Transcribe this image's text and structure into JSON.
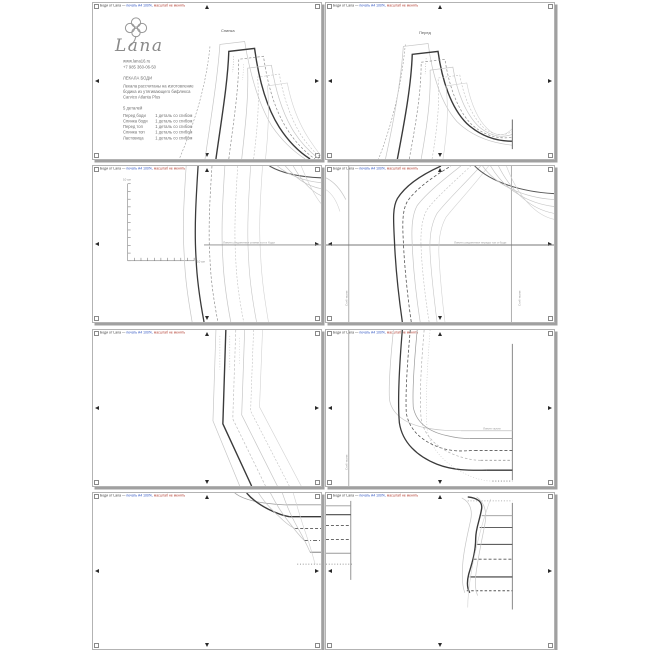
{
  "document": {
    "kind": "sewing-pattern-print-sheet",
    "pages_count": 8,
    "brand": "Lana"
  },
  "page_header": {
    "segments": [
      {
        "t": "Боди от Lana —",
        "c": "#3a3a3a"
      },
      {
        "t": " печать А4 100%,",
        "c": "#2b51c0"
      },
      {
        "t": " масштаб не менять",
        "c": "#b23b2e"
      }
    ]
  },
  "logo_block": {
    "brand": "Lana",
    "website": "www.lana16.ru",
    "phone": "+7 985 360-06-50",
    "title": "ЛЕКАЛА БОДИ",
    "description_lines": [
      "Лекала рассчитаны на изготовление",
      "бодика из утягивающего бифлекса",
      "Carvico Atlanta Plus"
    ],
    "parts_count_label": "5 деталей",
    "parts": [
      {
        "name": "Перед боди",
        "qty": "1 деталь со сгибом"
      },
      {
        "name": "Спинка боди",
        "qty": "1 деталь со сгибом"
      },
      {
        "name": "Перед топ",
        "qty": "1 деталь со сгибом"
      },
      {
        "name": "Спинка топ",
        "qty": "1 деталь со сгибом"
      },
      {
        "name": "Ластовица",
        "qty": "1 деталь со сгибом"
      }
    ]
  },
  "colors": {
    "bold_line": "#3a3a3a",
    "dark_line": "#555555",
    "mid_line": "#9a9a9a",
    "light_line": "#c6c6c6",
    "page_shadow": "#a0a0a0",
    "page_border": "#b3b3b3"
  },
  "pages": [
    {
      "strokes": [
        {
          "d": "M118,44 C114,84 103,120 87,158",
          "c": "#9a9a9a",
          "w": 0.6,
          "da": "2 1.6"
        },
        {
          "d": "M113,158 C120,110 126,72 128,42 L153,39 C158,70 166,100 180,124 C190,139 202,150 214,158",
          "c": "#c6c6c6",
          "w": 0.7
        },
        {
          "d": "M124,158 C130,115 136,80 137,49 L163,46 C167,76 174,104 188,126 C197,140 208,151 219,158",
          "c": "#3a3a3a",
          "w": 1.4
        },
        {
          "d": "M137,158 C142,118 147,88 147,57 L172,54 C176,82 183,108 196,128 C204,141 214,151 224,158",
          "c": "#8f8f8f",
          "w": 0.7,
          "da": "2.5 1.8"
        },
        {
          "d": "M150,158 C154,122 157,95 156,66 L180,63 C184,88 191,112 203,131 C210,142 219,151 228,158",
          "c": "#c6c6c6",
          "w": 0.7
        },
        {
          "d": "M162,158 C166,126 168,100 166,75 L188,72 C192,95 199,116 210,134 C216,143 224,152 230,157",
          "c": "#c0c0c0",
          "w": 0.6,
          "da": "2 1.6"
        },
        {
          "d": "M174,158 C177,130 178,106 176,84 L196,81 C200,102 207,121 218,138 C222,144 227,151 230,155",
          "c": "#d2d2d2",
          "w": 0.6
        },
        {
          "d": "M142,54 L141,70",
          "c": "#9a9a9a",
          "w": 0.5,
          "da": "1 1.6"
        },
        {
          "d": "M152,62 L151,78",
          "c": "#b8b8b8",
          "w": 0.5,
          "da": "1 1.6"
        }
      ],
      "labels": [
        {
          "t": "Спинка",
          "x": 128,
          "y": 26,
          "s": 4,
          "c": "#555555",
          "n": "piece-label-spinka"
        }
      ]
    },
    {
      "strokes": [
        {
          "d": "M80,42 C76,84 67,122 53,158",
          "c": "#9a9a9a",
          "w": 0.6,
          "da": "2 1.6"
        },
        {
          "d": "M60,158 C70,112 76,74 78,44 L103,41 C107,72 116,102 132,120 C148,136 168,142 188,144",
          "c": "#c6c6c6",
          "w": 0.7
        },
        {
          "d": "M72,158 C80,116 86,82 87,52 L113,49 C117,78 126,106 142,122 C156,135 172,140 188,140",
          "c": "#3a3a3a",
          "w": 1.4
        },
        {
          "d": "M84,158 C91,120 96,90 96,60 L120,57 C124,84 133,110 148,124 C161,135 175,138 188,136",
          "c": "#8f8f8f",
          "w": 0.7,
          "da": "2.5 1.8"
        },
        {
          "d": "M96,158 C102,124 106,96 105,68 L128,65 C132,90 141,113 155,126 C166,135 178,137 188,133",
          "c": "#c6c6c6",
          "w": 0.7
        },
        {
          "d": "M107,158 C112,128 115,102 113,76 L135,73 C139,96 148,117 161,128 C170,134 180,135 188,130",
          "c": "#c0c0c0",
          "w": 0.6,
          "da": "2 1.6"
        },
        {
          "d": "M118,158 C122,132 124,108 121,84 L142,81 C146,102 154,121 166,130 C173,135 181,135 188,127",
          "c": "#d2d2d2",
          "w": 0.6
        },
        {
          "d": "M188,118 L188,148",
          "c": "#777777",
          "w": 1.1
        },
        {
          "d": "M101,56 L100,72",
          "c": "#9a9a9a",
          "w": 0.5,
          "da": "1 1.6"
        }
      ],
      "labels": [
        {
          "t": "Перед",
          "x": 93,
          "y": 28,
          "s": 4,
          "c": "#555555",
          "n": "piece-label-pered"
        }
      ]
    },
    {
      "strokes": [
        {
          "d": "M35,18 L35,96 M35,18 L38,18 M35,25.8 L38,25.8 M35,33.6 L38,33.6 M35,41.4 L38,41.4 M35,49.2 L38,49.2 M35,57 L38,57 M35,64.8 L38,64.8 M35,72.6 L38,72.6 M35,80.4 L38,80.4 M35,88.2 L38,88.2 M35,96 L38,96",
          "c": "#666666",
          "w": 0.5
        },
        {
          "d": "M35,96 L102,96 M41.7,96 L41.7,93 M48.4,96 L48.4,93 M55.1,96 L55.1,93 M61.8,96 L61.8,93 M68.5,96 L68.5,93 M75.2,96 L75.2,93 M81.9,96 L81.9,93 M88.6,96 L88.6,93 M95.3,96 L95.3,93 M102,96 L102,93",
          "c": "#666666",
          "w": 0.5
        },
        {
          "d": "M94,0 C92,30 90,60 92,90 C93,118 97,140 100,158",
          "c": "#c6c6c6",
          "w": 0.7
        },
        {
          "d": "M106,0 C104,32 102,64 104,94 C105,120 109,142 112,158",
          "c": "#3a3a3a",
          "w": 1.3
        },
        {
          "d": "M120,0 C118,32 116,64 118,94 C119,120 123,142 126,158",
          "c": "#8f8f8f",
          "w": 0.7,
          "da": "2.5 1.8"
        },
        {
          "d": "M133,0 C131,32 129,64 131,94 C132,120 136,142 139,158",
          "c": "#c6c6c6",
          "w": 0.7
        },
        {
          "d": "M146,0 C144,32 142,64 144,94 C145,120 149,142 152,158",
          "c": "#c0c0c0",
          "w": 0.6,
          "da": "2 1.6"
        },
        {
          "d": "M159,0 C157,32 155,64 157,94 C158,120 162,142 165,158",
          "c": "#c6c6c6",
          "w": 0.6
        },
        {
          "d": "M171,0 C169,30 167,60 169,88 C170,116 174,140 177,158",
          "c": "#d2d2d2",
          "w": 0.6
        },
        {
          "d": "M178,0 C190,7 206,11 230,12",
          "c": "#555555",
          "w": 1.1
        },
        {
          "d": "M186,0 C198,10 212,15 230,17",
          "c": "#c6c6c6",
          "w": 0.7
        },
        {
          "d": "M194,0 C206,14 216,20 230,23",
          "c": "#c6c6c6",
          "w": 0.7
        },
        {
          "d": "M202,0 C212,18 221,26 230,30",
          "c": "#c0c0c0",
          "w": 0.6
        },
        {
          "d": "M210,0 C219,22 225,32 230,38",
          "c": "#d2d2d2",
          "w": 0.6
        },
        {
          "d": "M112,80 L230,80",
          "c": "#8a8a8a",
          "w": 0.9
        }
      ],
      "labels": [
        {
          "t": "10 см",
          "x": 30,
          "y": 12,
          "s": 3,
          "c": "#888888",
          "n": "ruler-label-vertical"
        },
        {
          "t": "10 см",
          "x": 104,
          "y": 94,
          "s": 3,
          "c": "#888888",
          "n": "ruler-label-horizontal"
        },
        {
          "t": "Линия соединения спинки топ и боди",
          "x": 130,
          "y": 75,
          "s": 3,
          "c": "#999999",
          "n": "join-line-label"
        }
      ]
    },
    {
      "strokes": [
        {
          "d": "M23,0 L23,158",
          "c": "#9a9a9a",
          "w": 0.8
        },
        {
          "d": "M187,0 L187,158",
          "c": "#9a9a9a",
          "w": 0.8
        },
        {
          "d": "M0,80 L230,80",
          "c": "#777777",
          "w": 1
        },
        {
          "d": "M77,158 C73,130 70,100 69,75 C68,55 67,42 72,33 C80,20 96,9 116,0",
          "c": "#3a3a3a",
          "w": 1.3
        },
        {
          "d": "M86,158 C82,130 79,100 78,76 C77,58 77,45 82,36 C90,24 106,12 126,0",
          "c": "#555555",
          "w": 0.8,
          "da": "3 2"
        },
        {
          "d": "M95,158 C91,132 88,104 87,80 C86,62 87,49 92,40 C101,28 117,15 136,0",
          "c": "#c6c6c6",
          "w": 0.7
        },
        {
          "d": "M104,158 C100,132 97,106 96,84 C95,66 97,53 102,44 C111,32 127,18 146,0",
          "c": "#c0c0c0",
          "w": 0.6,
          "da": "2 1.6"
        },
        {
          "d": "M112,158 C109,134 106,108 105,88 C104,70 107,57 112,48 C121,36 137,21 156,0",
          "c": "#c6c6c6",
          "w": 0.6
        },
        {
          "d": "M120,158 C117,134 115,110 114,92 C113,74 116,61 121,52 C130,40 146,24 164,0",
          "c": "#d2d2d2",
          "w": 0.6
        },
        {
          "d": "M0,12 C8,16 15,24 20,34",
          "c": "#c6c6c6",
          "w": 0.7
        },
        {
          "d": "M0,24 C6,28 11,36 14,46",
          "c": "#d2d2d2",
          "w": 0.6
        },
        {
          "d": "M150,0 C166,16 196,26 230,28",
          "c": "#555555",
          "w": 1
        },
        {
          "d": "M158,0 C172,20 200,32 230,34",
          "c": "#c6c6c6",
          "w": 0.7
        },
        {
          "d": "M166,0 C180,24 204,38 230,41",
          "c": "#c6c6c6",
          "w": 0.7
        },
        {
          "d": "M174,0 C188,28 208,44 230,48",
          "c": "#c0c0c0",
          "w": 0.6
        },
        {
          "d": "M182,0 C194,32 212,50 230,54",
          "c": "#d2d2d2",
          "w": 0.6
        }
      ],
      "labels": [
        {
          "t": "Линия соединения переда топ и боди",
          "x": 128,
          "y": 75,
          "s": 3,
          "c": "#999999",
          "n": "join-line-label"
        },
        {
          "t": "Сгиб ткани",
          "x": 19,
          "y": 140,
          "s": 3,
          "r": -90,
          "c": "#999999",
          "n": "fold-line-label"
        },
        {
          "t": "Сгиб ткани",
          "x": 192,
          "y": 140,
          "s": 3,
          "r": -90,
          "c": "#999999",
          "n": "fold-line-label"
        }
      ]
    },
    {
      "strokes": [
        {
          "d": "M124,0 C123,30 122,60 121,92 L148,158",
          "c": "#c6c6c6",
          "w": 0.7
        },
        {
          "d": "M134,0 C133,30 132,62 131,95 L160,158",
          "c": "#3a3a3a",
          "w": 1.4
        },
        {
          "d": "M144,0 C143,30 142,60 141,90 L174,158",
          "c": "#bfbfbf",
          "w": 0.7,
          "da": "2.5 1.8"
        },
        {
          "d": "M153,0 C152,28 151,56 150,86 L186,158",
          "c": "#c6c6c6",
          "w": 0.7
        },
        {
          "d": "M162,0 C161,26 160,52 159,82 L198,158",
          "c": "#c0c0c0",
          "w": 0.6,
          "da": "2 1.6"
        },
        {
          "d": "M171,0 C170,24 169,50 168,78 L210,158",
          "c": "#d2d2d2",
          "w": 0.6
        },
        {
          "d": "M128,6 L128,40",
          "c": "#b0b0b0",
          "w": 0.5,
          "da": "1 1.8"
        },
        {
          "d": "M138,6 L138,40",
          "c": "#b0b0b0",
          "w": 0.5,
          "da": "1 1.8"
        },
        {
          "d": "M148,8 L148,36",
          "c": "#c6c6c6",
          "w": 0.5,
          "da": "1 1.8"
        }
      ],
      "labels": []
    },
    {
      "strokes": [
        {
          "d": "M23,0 L23,158",
          "c": "#9a9a9a",
          "w": 0.8
        },
        {
          "d": "M188,14 L188,152",
          "c": "#888888",
          "w": 1
        },
        {
          "d": "M68,0 C65,30 63,55 64,70 C66,85 80,95 100,99 C115,102 126,102 136,102",
          "c": "#c6c6c6",
          "w": 0.7
        },
        {
          "d": "M77,0 C74,36 72,70 74,94 C77,114 92,128 112,136 C130,143 148,142 162,142",
          "c": "#3a3a3a",
          "w": 1.3
        },
        {
          "d": "M85,0 C82,34 80,64 81,84 C84,102 98,114 118,120 C132,124 142,122 150,122",
          "c": "#555555",
          "w": 0.8,
          "da": "3 2"
        },
        {
          "d": "M92,0 C89,32 87,60 88,78 C91,94 104,103 122,107 C134,110 140,110 145,110",
          "c": "#9a9a9a",
          "w": 0.7
        },
        {
          "d": "M99,0 C96,36 94,68 96,90 C99,108 113,120 131,127 C143,131 150,132 156,132",
          "c": "#b0b0b0",
          "w": 0.7,
          "da": "2.5 2"
        },
        {
          "d": "M105,0 C102,40 100,76 102,100 C105,120 119,134 137,144 C151,151 160,153 168,153",
          "c": "#c6c6c6",
          "w": 0.6,
          "da": "1 1.8"
        },
        {
          "d": "M136,102 L188,102",
          "c": "#c0c0c0",
          "w": 0.8
        },
        {
          "d": "M145,110 L188,110",
          "c": "#9a9a9a",
          "w": 0.9
        },
        {
          "d": "M150,122 L188,122",
          "c": "#555555",
          "w": 0.9,
          "da": "3 2"
        },
        {
          "d": "M156,132 L188,132",
          "c": "#9a9a9a",
          "w": 0.9,
          "da": "2.5 2"
        },
        {
          "d": "M162,142 L188,142",
          "c": "#3a3a3a",
          "w": 1.3
        },
        {
          "d": "M168,153 L188,153",
          "c": "#777777",
          "w": 0.8,
          "da": "1 1.8"
        }
      ],
      "labels": [
        {
          "t": "Линия талии",
          "x": 157,
          "y": 97,
          "s": 3,
          "c": "#999999",
          "n": "waist-line-label"
        },
        {
          "t": "Сгиб ткани",
          "x": 19,
          "y": 140,
          "s": 3,
          "r": -90,
          "c": "#999999",
          "n": "fold-line-label"
        }
      ]
    },
    {
      "strokes": [
        {
          "d": "M143,0 C148,4 158,8 172,10 C180,11 188,12 196,12",
          "c": "#9a9a9a",
          "w": 0.7
        },
        {
          "d": "M196,12 L230,12",
          "c": "#9a9a9a",
          "w": 0.9
        },
        {
          "d": "M155,0 C160,6 168,12 178,17 C186,21 192,23 198,24",
          "c": "#3a3a3a",
          "w": 1.4
        },
        {
          "d": "M198,24 L230,24",
          "c": "#3a3a3a",
          "w": 1.3
        },
        {
          "d": "M167,0 C172,8 179,16 188,24 C194,30 199,34 204,36",
          "c": "#c6c6c6",
          "w": 0.7
        },
        {
          "d": "M204,36 L230,36",
          "c": "#555555",
          "w": 0.9,
          "da": "3 2"
        },
        {
          "d": "M179,0 C184,10 190,20 198,30 C204,38 209,44 213,48",
          "c": "#c6c6c6",
          "w": 0.7
        },
        {
          "d": "M213,48 L230,48",
          "c": "#555555",
          "w": 0.9,
          "da": "4 2 1 2"
        },
        {
          "d": "M191,0 C195,12 200,24 207,36 C212,45 216,53 219,60",
          "c": "#c0c0c0",
          "w": 0.6
        },
        {
          "d": "M219,60 L230,60",
          "c": "#8a8a8a",
          "w": 1.1
        },
        {
          "d": "M202,0 C206,14 210,28 215,42 C219,54 222,64 224,72",
          "c": "#d2d2d2",
          "w": 0.6
        },
        {
          "d": "M206,72 L230,72",
          "c": "#777777",
          "w": 0.8,
          "da": "1 1.8"
        }
      ],
      "labels": []
    },
    {
      "strokes": [
        {
          "d": "M25,8 L25,88",
          "c": "#888888",
          "w": 0.9
        },
        {
          "d": "M0,13 L25,13",
          "c": "#9a9a9a",
          "w": 0.9
        },
        {
          "d": "M0,22 L25,22",
          "c": "#4a4a4a",
          "w": 1.1
        },
        {
          "d": "M0,33 L25,33",
          "c": "#555555",
          "w": 0.9,
          "da": "3 2"
        },
        {
          "d": "M0,47 L25,47",
          "c": "#555555",
          "w": 0.9,
          "da": "3 2"
        },
        {
          "d": "M0,61 L25,61",
          "c": "#9a9a9a",
          "w": 1
        },
        {
          "d": "M0,72 L28,72",
          "c": "#777777",
          "w": 0.8,
          "da": "1 1.8"
        },
        {
          "d": "M188,10 L188,118",
          "c": "#888888",
          "w": 1
        },
        {
          "d": "M143,8 L188,8",
          "c": "#999999",
          "w": 0.7,
          "da": "1 1.8"
        },
        {
          "d": "M157,23 L188,23",
          "c": "#9a9a9a",
          "w": 0.9
        },
        {
          "d": "M155,35 L188,35",
          "c": "#4a4a4a",
          "w": 1
        },
        {
          "d": "M152,52 L188,52",
          "c": "#4a4a4a",
          "w": 1
        },
        {
          "d": "M149,67 L188,67",
          "c": "#555555",
          "w": 0.9,
          "da": "3 2"
        },
        {
          "d": "M145,85 L188,85",
          "c": "#3a3a3a",
          "w": 1.2
        },
        {
          "d": "M142,99 L188,99",
          "c": "#555555",
          "w": 0.9,
          "da": "2.5 2"
        },
        {
          "d": "M143,4 C153,5 158,9 157,16 C155,28 151,36 151,46 C151,60 147,72 144,82 C142,90 142,96 145,101",
          "c": "#3a3a3a",
          "w": 1.4
        },
        {
          "d": "M137,5 C145,9 148,17 146,27 C143,41 139,57 138,71 C137,83 137,93 140,101",
          "c": "#c6c6c6",
          "w": 0.7
        },
        {
          "d": "M152,4 C160,10 163,20 160,33 C157,49 153,67 151,84 C150,93 151,99 153,104",
          "c": "#c6c6c6",
          "w": 0.7
        },
        {
          "d": "M166,6 C158,28 150,58 146,84 C144,96 143,106 143,116",
          "c": "#d2d2d2",
          "w": 0.6
        }
      ],
      "labels": []
    }
  ]
}
